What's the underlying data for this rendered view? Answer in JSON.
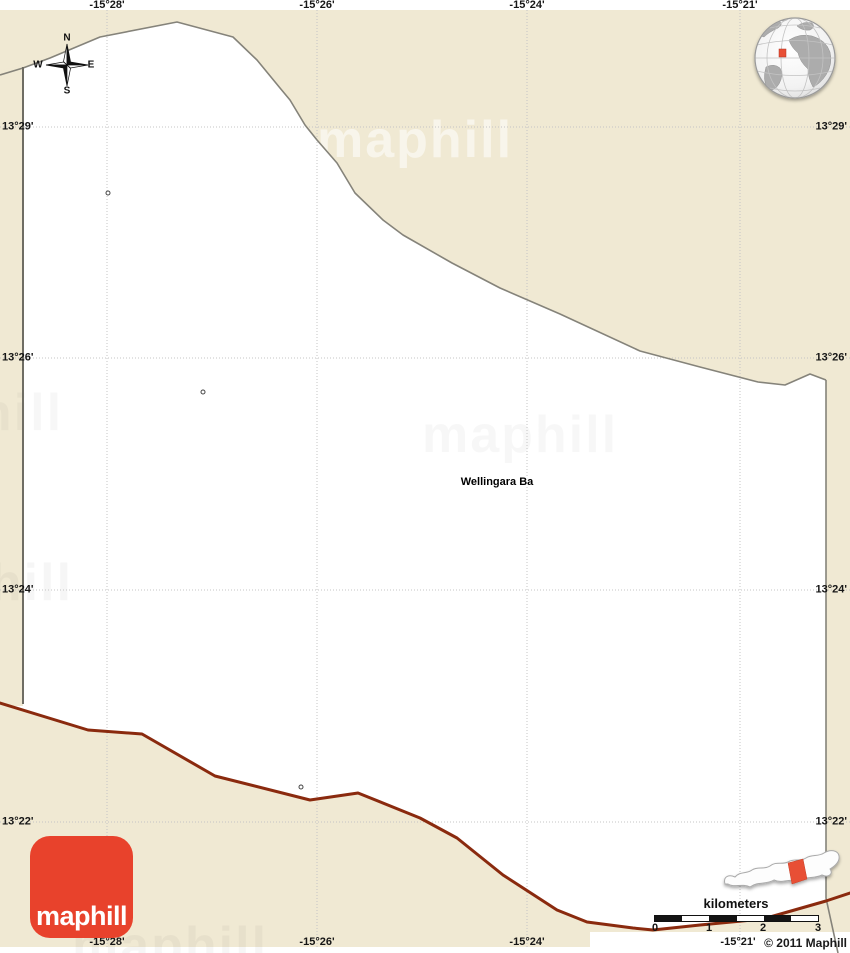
{
  "title": {
    "place_label": "Wellingara Ba"
  },
  "watermark": {
    "text": "maphill"
  },
  "axis": {
    "top": [
      "-15°28'",
      "-15°26'",
      "-15°24'",
      "-15°21'"
    ],
    "bottom": [
      "-15°28'",
      "-15°26'",
      "-15°24'",
      "-15°21'"
    ],
    "left": [
      "13°29'",
      "13°26'",
      "13°24'",
      "13°22'"
    ],
    "right": [
      "13°29'",
      "13°26'",
      "13°24'",
      "13°22'"
    ]
  },
  "compass": {
    "north": "N",
    "south": "S",
    "east": "E",
    "west": "W"
  },
  "scale_bar": {
    "unit_label": "kilometers",
    "ticks": [
      "0",
      "1",
      "2",
      "3"
    ]
  },
  "logo": {
    "label": "maphill"
  },
  "footer": {
    "copyright": "© 2011 Maphill"
  },
  "colors": {
    "land_beige": "#f0e9d3",
    "district_white": "#ffffff",
    "boundary_gray": "#85837a",
    "region_boundary_maroon": "#8a2a0e",
    "brand_red": "#e8422c",
    "locator_highlight": "#e85036"
  }
}
